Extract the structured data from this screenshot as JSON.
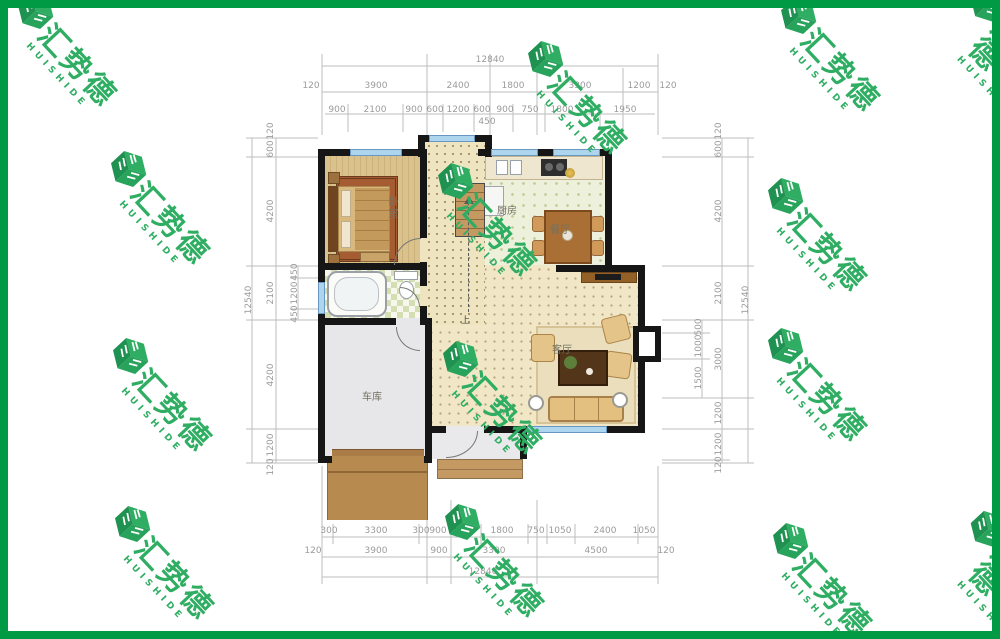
{
  "frame_color": "#009a44",
  "watermarks": {
    "cn": "汇势德",
    "en": "HUISHIDE",
    "color": "#2fae63",
    "positions": [
      [
        65,
        52
      ],
      [
        575,
        100
      ],
      [
        828,
        57
      ],
      [
        1002,
        50
      ],
      [
        158,
        210
      ],
      [
        485,
        222
      ],
      [
        815,
        237
      ],
      [
        160,
        397
      ],
      [
        490,
        400
      ],
      [
        815,
        387
      ],
      [
        162,
        565
      ],
      [
        492,
        563
      ],
      [
        820,
        582
      ],
      [
        1002,
        575
      ]
    ]
  },
  "rooms": {
    "bedroom": "卧室",
    "kitchen": "厨房",
    "dining": "餐厅",
    "living": "客厅",
    "garage": "车库",
    "stair_up": "上"
  },
  "dimensions": {
    "labels": [
      {
        "t": "12840",
        "x": 490,
        "y": 60
      },
      {
        "t": "120",
        "x": 311,
        "y": 86
      },
      {
        "t": "3900",
        "x": 376,
        "y": 86
      },
      {
        "t": "2400",
        "x": 458,
        "y": 86
      },
      {
        "t": "1800",
        "x": 513,
        "y": 86
      },
      {
        "t": "3300",
        "x": 580,
        "y": 86
      },
      {
        "t": "1200",
        "x": 639,
        "y": 86
      },
      {
        "t": "120",
        "x": 668,
        "y": 86
      },
      {
        "t": "900",
        "x": 337,
        "y": 110
      },
      {
        "t": "2100",
        "x": 375,
        "y": 110
      },
      {
        "t": "900",
        "x": 414,
        "y": 110
      },
      {
        "t": "600",
        "x": 435,
        "y": 110
      },
      {
        "t": "1200",
        "x": 458,
        "y": 110
      },
      {
        "t": "600",
        "x": 482,
        "y": 110
      },
      {
        "t": "900",
        "x": 505,
        "y": 110
      },
      {
        "t": "750",
        "x": 530,
        "y": 110
      },
      {
        "t": "1800",
        "x": 562,
        "y": 110
      },
      {
        "t": "1950",
        "x": 625,
        "y": 110
      },
      {
        "t": "450",
        "x": 487,
        "y": 122
      },
      {
        "t": "300",
        "x": 329,
        "y": 531
      },
      {
        "t": "3300",
        "x": 376,
        "y": 531
      },
      {
        "t": "300",
        "x": 421,
        "y": 531
      },
      {
        "t": "900",
        "x": 438,
        "y": 531
      },
      {
        "t": "1150",
        "x": 464,
        "y": 531
      },
      {
        "t": "1800",
        "x": 502,
        "y": 531
      },
      {
        "t": "750",
        "x": 536,
        "y": 531
      },
      {
        "t": "1050",
        "x": 560,
        "y": 531
      },
      {
        "t": "2400",
        "x": 605,
        "y": 531
      },
      {
        "t": "1050",
        "x": 644,
        "y": 531
      },
      {
        "t": "120",
        "x": 313,
        "y": 551
      },
      {
        "t": "3900",
        "x": 376,
        "y": 551
      },
      {
        "t": "900",
        "x": 439,
        "y": 551
      },
      {
        "t": "3300",
        "x": 494,
        "y": 551
      },
      {
        "t": "4500",
        "x": 596,
        "y": 551
      },
      {
        "t": "120",
        "x": 666,
        "y": 551
      },
      {
        "t": "12840",
        "x": 483,
        "y": 572
      },
      {
        "t": "12540",
        "x": 249,
        "y": 300,
        "r": 1
      },
      {
        "t": "120",
        "x": 271,
        "y": 131,
        "r": 1
      },
      {
        "t": "600",
        "x": 271,
        "y": 149,
        "r": 1
      },
      {
        "t": "4200",
        "x": 271,
        "y": 211,
        "r": 1
      },
      {
        "t": "2100",
        "x": 271,
        "y": 293,
        "r": 1
      },
      {
        "t": "4200",
        "x": 271,
        "y": 375,
        "r": 1
      },
      {
        "t": "1200",
        "x": 271,
        "y": 445,
        "r": 1
      },
      {
        "t": "120",
        "x": 271,
        "y": 467,
        "r": 1
      },
      {
        "t": "450",
        "x": 295,
        "y": 272,
        "r": 1
      },
      {
        "t": "1200",
        "x": 295,
        "y": 293,
        "r": 1
      },
      {
        "t": "450",
        "x": 295,
        "y": 314,
        "r": 1
      },
      {
        "t": "120",
        "x": 719,
        "y": 131,
        "r": 1
      },
      {
        "t": "600",
        "x": 719,
        "y": 149,
        "r": 1
      },
      {
        "t": "4200",
        "x": 719,
        "y": 211,
        "r": 1
      },
      {
        "t": "2100",
        "x": 719,
        "y": 293,
        "r": 1
      },
      {
        "t": "3000",
        "x": 719,
        "y": 359,
        "r": 1
      },
      {
        "t": "1200",
        "x": 719,
        "y": 413,
        "r": 1
      },
      {
        "t": "1200",
        "x": 719,
        "y": 444,
        "r": 1
      },
      {
        "t": "120",
        "x": 719,
        "y": 465,
        "r": 1
      },
      {
        "t": "500",
        "x": 699,
        "y": 327,
        "r": 1
      },
      {
        "t": "1000",
        "x": 699,
        "y": 346,
        "r": 1
      },
      {
        "t": "1500",
        "x": 699,
        "y": 378,
        "r": 1
      },
      {
        "t": "12540",
        "x": 746,
        "y": 300,
        "r": 1
      }
    ],
    "lines": [
      [
        322,
        66,
        658,
        66
      ],
      [
        322,
        92,
        658,
        92
      ],
      [
        325,
        114,
        655,
        114
      ],
      [
        322,
        54,
        322,
        135
      ],
      [
        427,
        54,
        427,
        135
      ],
      [
        490,
        54,
        490,
        135
      ],
      [
        537,
        68,
        537,
        135
      ],
      [
        623,
        68,
        623,
        135
      ],
      [
        658,
        54,
        658,
        135
      ],
      [
        348,
        104,
        348,
        132
      ],
      [
        403,
        104,
        403,
        132
      ],
      [
        443,
        104,
        443,
        132
      ],
      [
        474,
        104,
        474,
        132
      ],
      [
        513,
        104,
        513,
        132
      ],
      [
        545,
        104,
        545,
        132
      ],
      [
        600,
        104,
        600,
        132
      ],
      [
        322,
        537,
        658,
        537
      ],
      [
        322,
        557,
        658,
        557
      ],
      [
        322,
        577,
        658,
        577
      ],
      [
        322,
        466,
        322,
        584
      ],
      [
        658,
        466,
        658,
        584
      ],
      [
        427,
        500,
        427,
        584
      ],
      [
        451,
        500,
        451,
        584
      ],
      [
        537,
        500,
        537,
        584
      ],
      [
        333,
        524,
        333,
        544
      ],
      [
        419,
        524,
        419,
        544
      ],
      [
        481,
        524,
        481,
        544
      ],
      [
        528,
        524,
        528,
        544
      ],
      [
        547,
        524,
        547,
        544
      ],
      [
        575,
        524,
        575,
        544
      ],
      [
        638,
        524,
        638,
        544
      ],
      [
        252,
        138,
        252,
        463
      ],
      [
        276,
        138,
        276,
        463
      ],
      [
        298,
        266,
        298,
        320
      ],
      [
        246,
        138,
        318,
        138
      ],
      [
        246,
        157,
        318,
        157
      ],
      [
        246,
        266,
        318,
        266
      ],
      [
        246,
        320,
        318,
        320
      ],
      [
        246,
        429,
        318,
        429
      ],
      [
        246,
        463,
        318,
        463
      ],
      [
        290,
        278,
        318,
        278
      ],
      [
        290,
        309,
        318,
        309
      ],
      [
        266,
        460,
        318,
        460
      ],
      [
        722,
        138,
        722,
        463
      ],
      [
        748,
        138,
        748,
        463
      ],
      [
        702,
        320,
        702,
        398
      ],
      [
        662,
        138,
        754,
        138
      ],
      [
        662,
        157,
        754,
        157
      ],
      [
        662,
        266,
        754,
        266
      ],
      [
        662,
        320,
        754,
        320
      ],
      [
        662,
        398,
        754,
        398
      ],
      [
        662,
        429,
        754,
        429
      ],
      [
        662,
        463,
        754,
        463
      ],
      [
        662,
        333,
        710,
        333
      ],
      [
        662,
        359,
        710,
        359
      ],
      [
        662,
        460,
        730,
        460
      ]
    ]
  }
}
